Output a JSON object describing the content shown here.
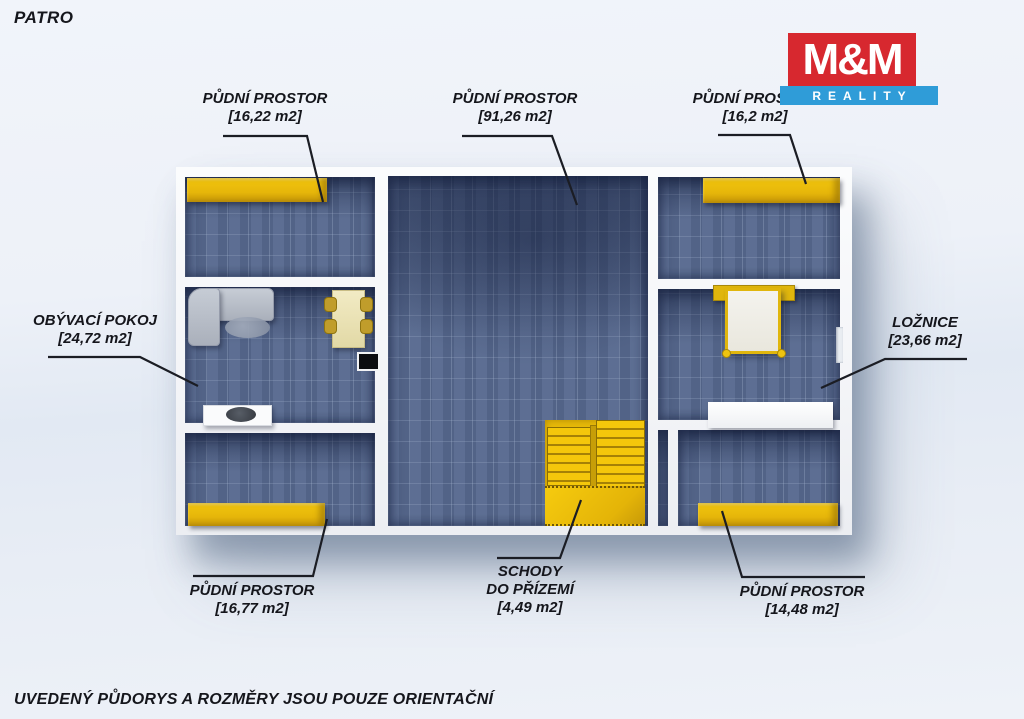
{
  "page": {
    "floor_label": "PATRO",
    "disclaimer": "UVEDENÝ PŮDORYS A ROZMĚRY JSOU POUZE ORIENTAČNÍ"
  },
  "logo": {
    "top_text": "M&M",
    "bottom_text": "REALITY",
    "red": "#d7282f",
    "blue": "#2f9cd8"
  },
  "colors": {
    "floor_blue": "#56688e",
    "accent_yellow": "#eaba0b",
    "wall_white": "#f6f7f9",
    "text_dark": "#15161c"
  },
  "rooms": [
    {
      "name": "PŮDNÍ PROSTOR",
      "area": "[16,22 m2]"
    },
    {
      "name": "PŮDNÍ PROSTOR",
      "area": "[91,26 m2]"
    },
    {
      "name": "PŮDNÍ PROSTOR",
      "area": "[16,2 m2]"
    },
    {
      "name": "OBÝVACÍ POKOJ",
      "area": "[24,72 m2]"
    },
    {
      "name": "LOŽNICE",
      "area": "[23,66 m2]"
    },
    {
      "name": "PŮDNÍ PROSTOR",
      "area": "[16,77 m2]"
    },
    {
      "name": "SCHODY",
      "name_line2": "DO PŘÍZEMÍ",
      "area": "[4,49 m2]"
    },
    {
      "name": "PŮDNÍ PROSTOR",
      "area": "[14,48 m2]"
    }
  ]
}
